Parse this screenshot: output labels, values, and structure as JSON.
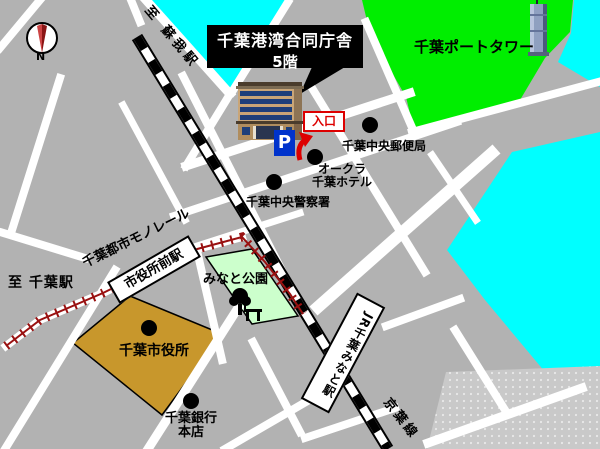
{
  "callout": {
    "line1": "千葉港湾合同庁舎",
    "line2": "5階"
  },
  "stations": {
    "jr_minato": "JR千葉みなと駅",
    "shiyakusho_mae": "市役所前駅",
    "keiyo_line": "京葉線",
    "monorail_line": "千葉都市モノレール",
    "to_soga": "至 蘇我駅",
    "to_chiba": "至 千葉駅"
  },
  "pois": {
    "port_tower": "千葉ポートタワー",
    "post_office": "千葉中央郵便局",
    "hotel_line1": "オークラ",
    "hotel_line2": "千葉ホテル",
    "police": "千葉中央警察署",
    "minato_park": "みなと公園",
    "city_hall": "千葉市役所",
    "bank_line1": "千葉銀行",
    "bank_line2": "本店"
  },
  "badges": {
    "entrance": "入口",
    "parking": "P",
    "compass_north": "N"
  },
  "colors": {
    "background": "#b2b2b2",
    "road": "#ffffff",
    "water": "#00ffff",
    "park_green": "#00ee00",
    "minato_park_green": "#ccffcc",
    "city_hall_tan": "#c8972c",
    "pier_gray": "#c9c9c9",
    "railway_black": "#000000",
    "monorail_red": "#991111",
    "callout_bg": "#000000",
    "callout_text": "#ffffff",
    "entrance_red": "#dd0000",
    "parking_blue": "#0033cc",
    "marker_black": "#000000"
  }
}
